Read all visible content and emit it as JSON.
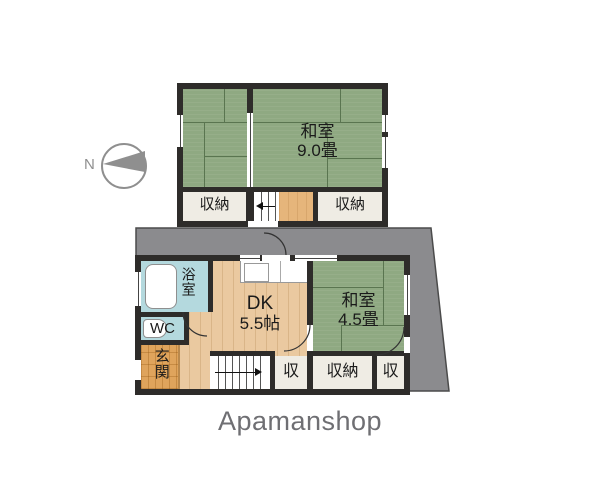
{
  "colors": {
    "wall": "#2e2c2a",
    "tatami": "#8fa982",
    "tatami_line": "#5a7550",
    "wood": "#eac9a0",
    "genkan": "#dfa45c",
    "hall2f": "#e6b57b",
    "bath": "#b4d9de",
    "storage": "#efece4",
    "lot": "#8b8b8e",
    "lot_border": "#4b4b4b",
    "label": "#1a1a1a",
    "logo": "#6f6f73",
    "compass": "#8f8f8f"
  },
  "compass": {
    "label": "N"
  },
  "floor2": {
    "room": {
      "name_line1": "和室",
      "size_line2": "9.0畳"
    },
    "storage_left": "収納",
    "storage_right": "収納"
  },
  "floor1": {
    "bath": "浴室",
    "wc": "WC",
    "entrance": "玄関",
    "dk": {
      "name_line1": "DK",
      "size_line2": "5.5帖"
    },
    "washitsu": {
      "name_line1": "和室",
      "size_line2": "4.5畳"
    },
    "storage_left": "収",
    "storage_center": "収納",
    "storage_right": "収"
  },
  "logo": {
    "text": "Apamanshop"
  }
}
